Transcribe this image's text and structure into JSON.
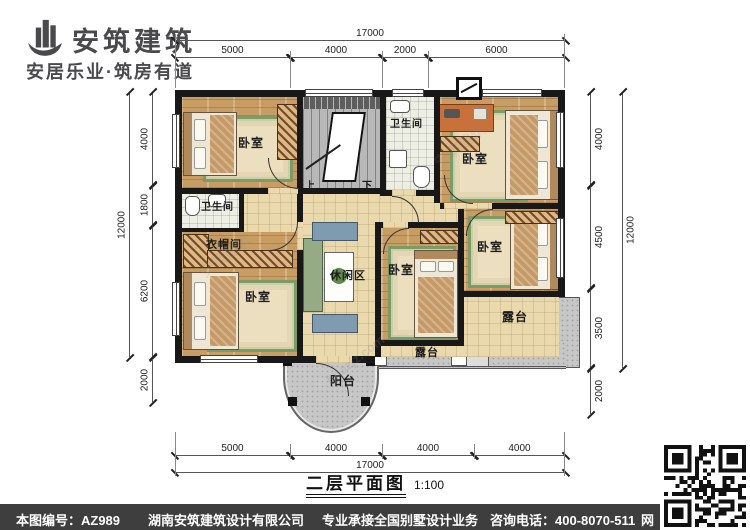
{
  "logo": {
    "name": "安筑建筑",
    "tagline": "安居乐业·筑房有道"
  },
  "dimensions": {
    "top": {
      "overall": "17000",
      "segments": [
        "5000",
        "4000",
        "2000",
        "6000"
      ]
    },
    "bottom": {
      "overall": "17000",
      "segments": [
        "5000",
        "4000",
        "4000",
        "4000"
      ]
    },
    "left": {
      "overall": "12000",
      "segments": [
        "4000",
        "1800",
        "6200",
        "2000"
      ]
    },
    "right": {
      "overall": "12000",
      "segments": [
        "4000",
        "4500",
        "3500",
        "2000"
      ]
    }
  },
  "rooms": {
    "bedroom_top_left": "卧室",
    "bedroom_top_right": "卧室",
    "bedroom_bottom_left": "卧室",
    "bedroom_center": "卧室",
    "bedroom_right": "卧室",
    "bathroom_top": "卫生间",
    "bathroom_left": "卫生间",
    "closet": "衣帽间",
    "leisure": "休闲区",
    "terrace_right": "露台",
    "terrace_bottom": "露台",
    "balcony": "阳台",
    "stair_up": "上",
    "stair_down": "下"
  },
  "title": {
    "text": "二层平面图",
    "scale": "1:100"
  },
  "footer": {
    "drawing_no": "本图编号：AZ989",
    "company": "湖南安筑建筑设计有限公司",
    "service": "专业承接全国别墅设计业务",
    "phone": "咨询电话：400-8070-511",
    "web_badge": "网"
  },
  "watermark": {
    "brand": "安筑建筑",
    "site": "hnazjz.com"
  },
  "colors": {
    "wall": "#181818",
    "wood": "#c89d63",
    "tile": "#e9d9ac",
    "outdoor_gray": "#c7c7c7",
    "rug_green": "#7f9a66",
    "footer_bg": "#3e3e3e"
  }
}
